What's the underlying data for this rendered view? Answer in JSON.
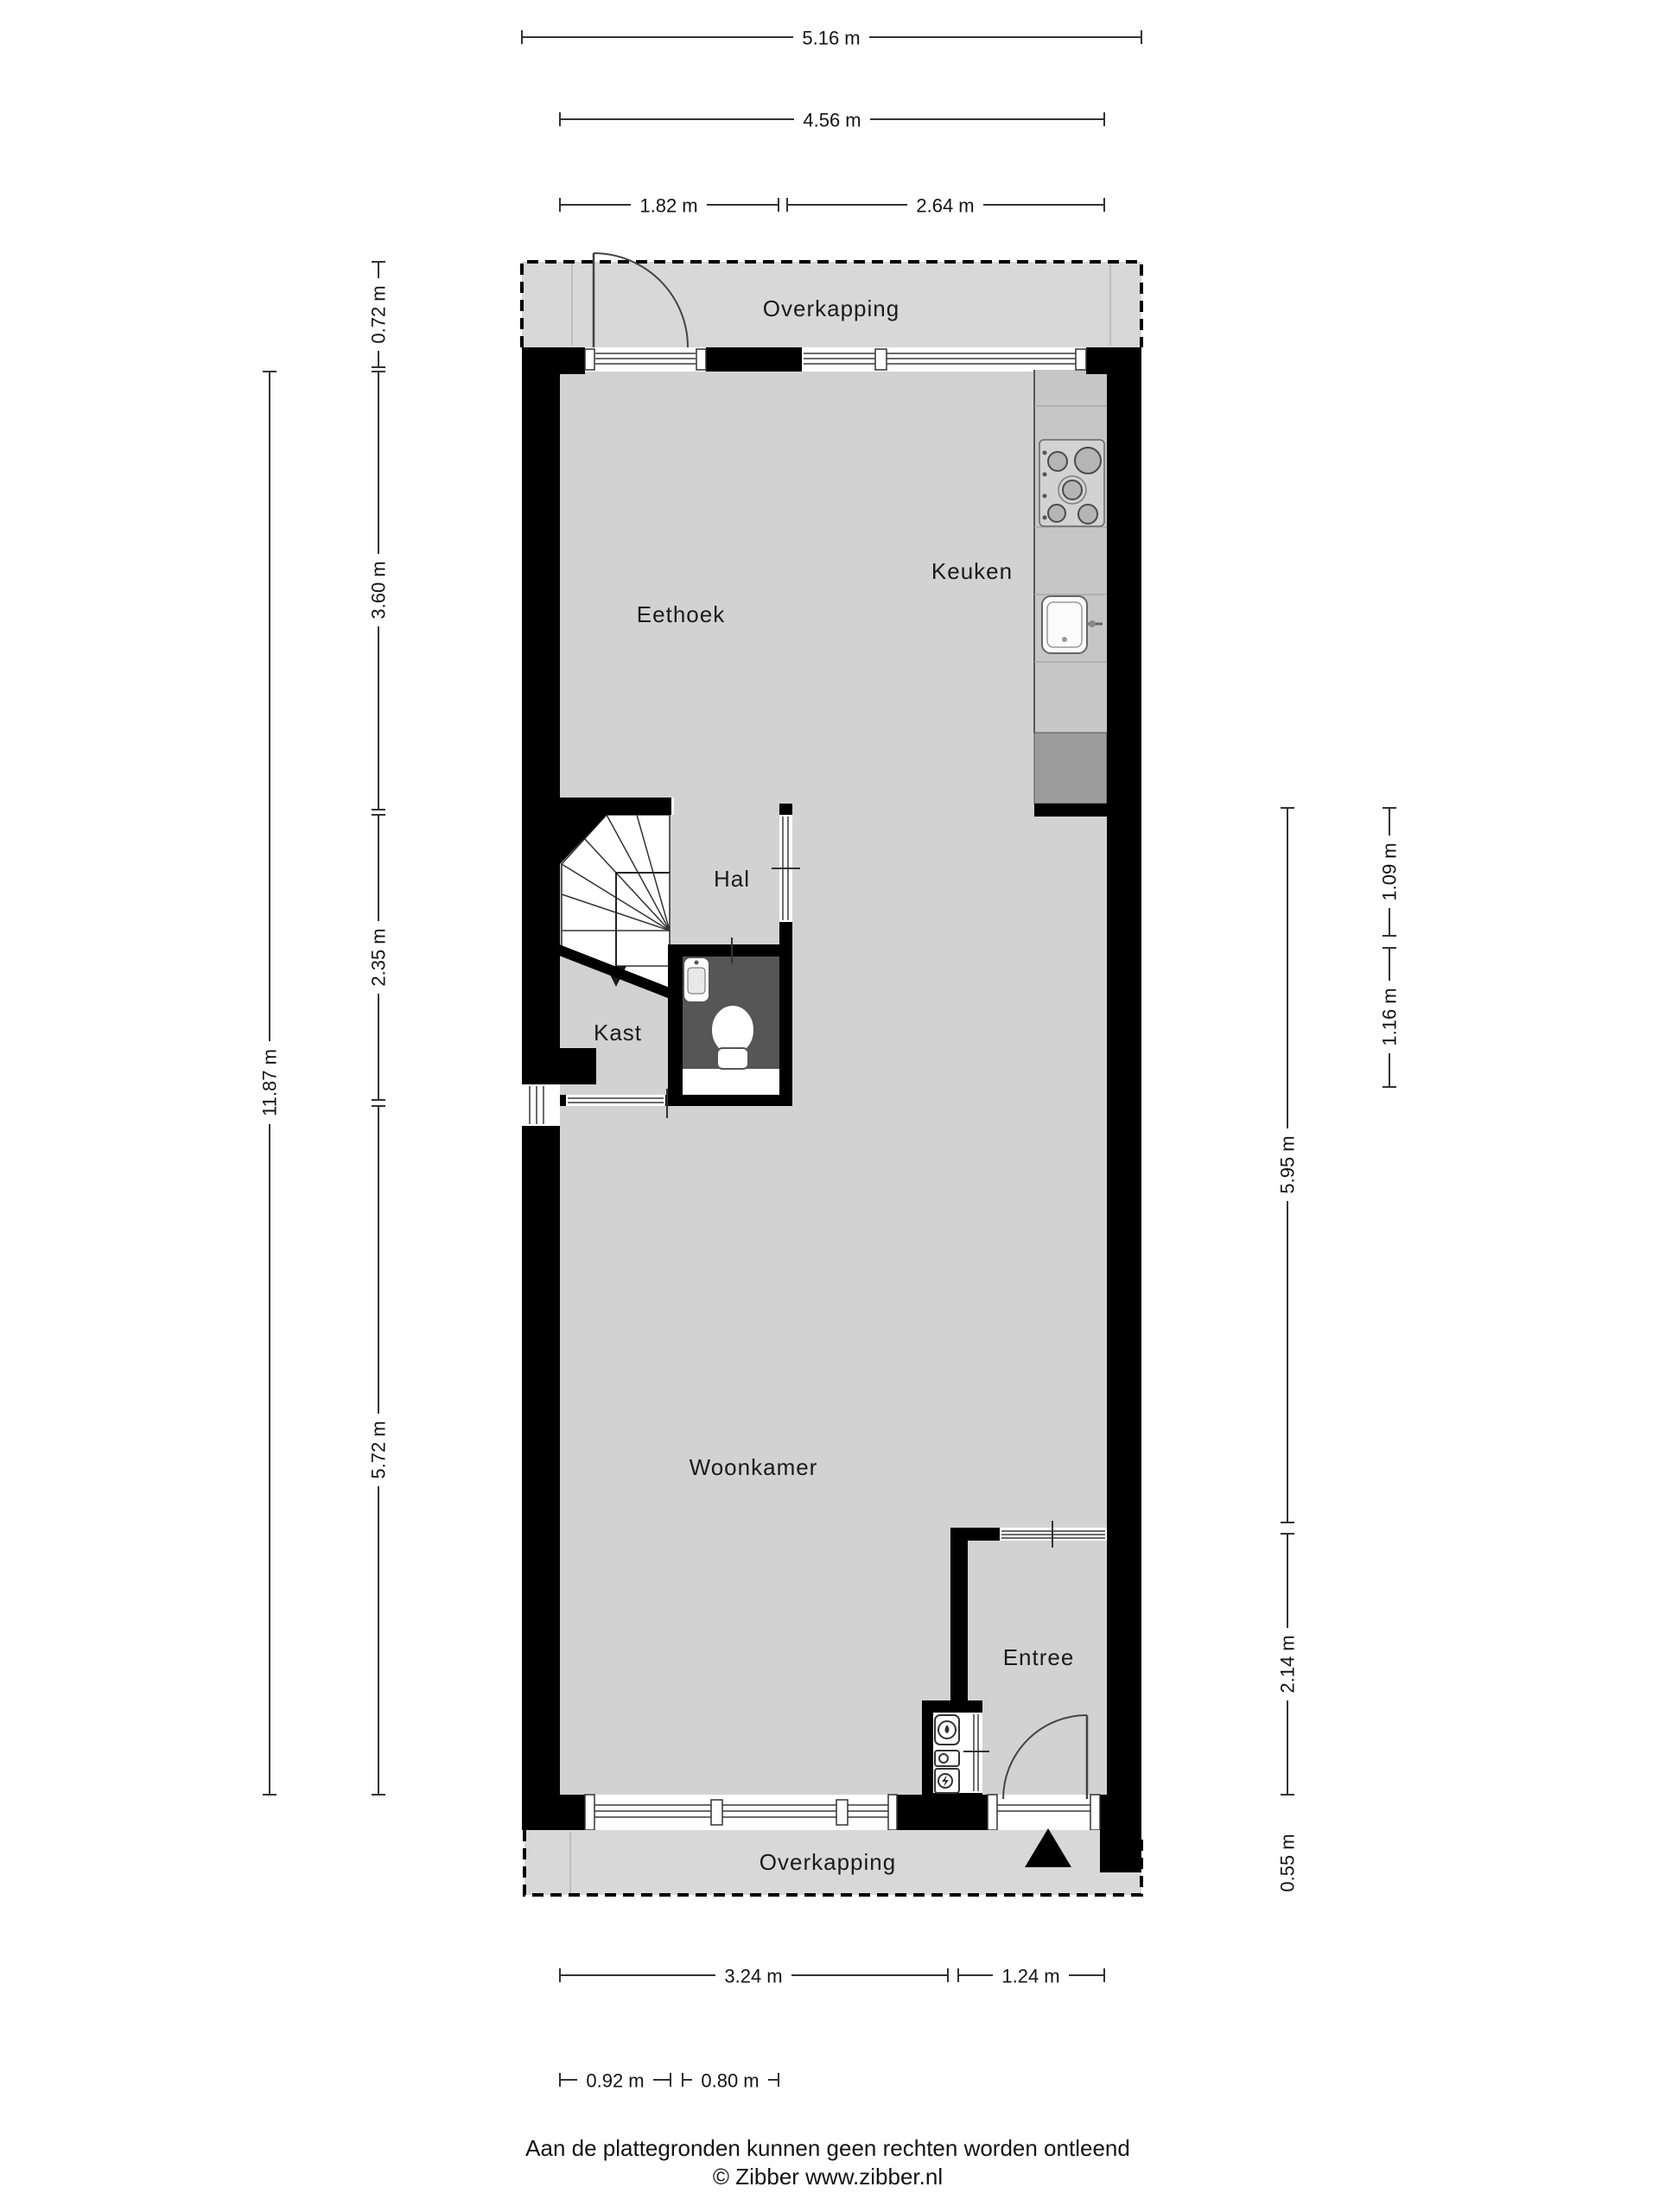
{
  "floorplan": {
    "rooms": {
      "canopy_top": "Overkapping",
      "eethoek": "Eethoek",
      "keuken": "Keuken",
      "hal": "Hal",
      "kast": "Kast",
      "woonkamer": "Woonkamer",
      "entree": "Entree",
      "canopy_bottom": "Overkapping"
    },
    "dimensions": {
      "top": [
        {
          "id": "total-width",
          "label": "5.16 m"
        },
        {
          "id": "inner-width",
          "label": "4.56 m"
        },
        {
          "id": "left-segment",
          "label": "1.82 m"
        },
        {
          "id": "right-segment",
          "label": "2.64 m"
        }
      ],
      "left": [
        {
          "id": "canopy-depth",
          "label": "0.72 m"
        },
        {
          "id": "eethoek-depth",
          "label": "3.60 m"
        },
        {
          "id": "middle-depth",
          "label": "2.35 m"
        },
        {
          "id": "woonkamer-depth",
          "label": "5.72 m"
        },
        {
          "id": "total-depth",
          "label": "11.87 m"
        }
      ],
      "right": [
        {
          "id": "upper-segment",
          "label": "1.09 m"
        },
        {
          "id": "toilet-depth",
          "label": "1.16 m"
        },
        {
          "id": "open-depth",
          "label": "5.95 m"
        },
        {
          "id": "entree-depth",
          "label": "2.14 m"
        },
        {
          "id": "canopy-depth",
          "label": "0.55 m"
        }
      ],
      "bottom": [
        {
          "id": "woonkamer-width",
          "label": "3.24 m"
        },
        {
          "id": "entree-width",
          "label": "1.24 m"
        },
        {
          "id": "kast-width",
          "label": "0.92 m"
        },
        {
          "id": "toilet-width",
          "label": "0.80 m"
        }
      ]
    },
    "footer": {
      "disclaimer": "Aan de plattegronden kunnen geen rechten worden ontleend",
      "credit": "© Zibber www.zibber.nl"
    },
    "colors": {
      "wall": "#000000",
      "floor": "#d2d2d2",
      "canopy_floor": "#d8d8d8",
      "toilet_floor": "#565656",
      "counter": "#c6c6c6",
      "counter_dark": "#9c9c9c",
      "dimension_line": "#333333"
    }
  }
}
